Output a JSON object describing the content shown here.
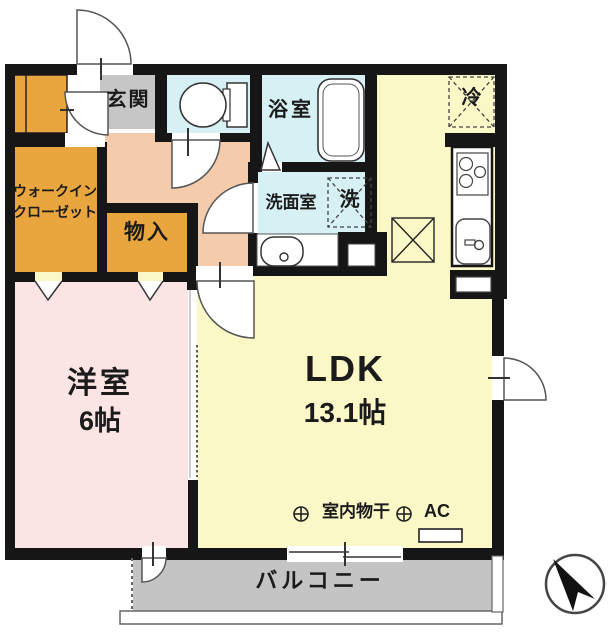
{
  "plan": {
    "title": "apartment floor plan",
    "entrance": "玄関",
    "bathroom": "浴室",
    "washroom": "洗面室",
    "washer": "洗",
    "fridge": "冷",
    "storage": "物入",
    "wic_line1": "ウォークイン",
    "wic_line2": "クローゼット",
    "western_room": "洋室",
    "western_room_size": "6帖",
    "ldk": "LDK",
    "ldk_size": "13.1帖",
    "indoor_drying": "室内物干",
    "ac": "AC",
    "balcony": "バルコニー"
  },
  "colors": {
    "wall": "#161616",
    "closet_orange": "#EAA63E",
    "hall_salmon": "#F5CCAB",
    "room_pink": "#FBE5E4",
    "ldk_yellow": "#FBF8C7",
    "wet_blue": "#D6F0F4",
    "entrance_gray": "#C6C6C6",
    "balcony_gray": "#C4C4C4"
  }
}
